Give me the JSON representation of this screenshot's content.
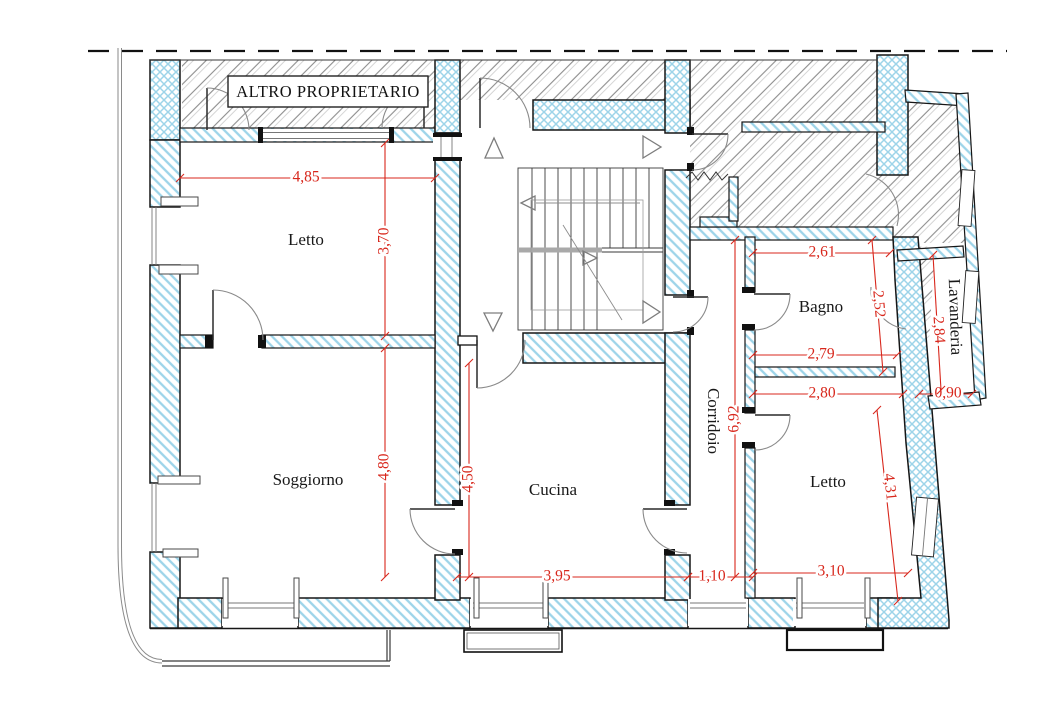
{
  "other_owner": {
    "label": "ALTRO PROPRIETARIO"
  },
  "rooms": [
    {
      "id": "letto-1",
      "label": "Letto",
      "x": 306,
      "y": 241,
      "rotation": 0
    },
    {
      "id": "soggiorno",
      "label": "Soggiorno",
      "x": 308,
      "y": 481,
      "rotation": 0
    },
    {
      "id": "cucina",
      "label": "Cucina",
      "x": 553,
      "y": 491,
      "rotation": 0
    },
    {
      "id": "corridoio",
      "label": "Corridoio",
      "x": 712,
      "y": 421,
      "rotation": 90
    },
    {
      "id": "bagno",
      "label": "Bagno",
      "x": 821,
      "y": 308,
      "rotation": 0
    },
    {
      "id": "lavanderia",
      "label": "Lavanderia",
      "x": 954,
      "y": 317,
      "rotation": 88
    },
    {
      "id": "letto-2",
      "label": "Letto",
      "x": 828,
      "y": 483,
      "rotation": 0
    }
  ],
  "dimensions": [
    {
      "id": "dim-4-85",
      "label": "4,85",
      "x": 306,
      "y": 178,
      "rotation": 0,
      "line": [
        180,
        178,
        435,
        178
      ]
    },
    {
      "id": "dim-3-70",
      "label": "3,70",
      "x": 385,
      "y": 241,
      "rotation": -90,
      "line": [
        385,
        143,
        385,
        336
      ]
    },
    {
      "id": "dim-4-80",
      "label": "4,80",
      "x": 385,
      "y": 467,
      "rotation": -90,
      "line": [
        385,
        348,
        385,
        577
      ]
    },
    {
      "id": "dim-4-50",
      "label": "4,50",
      "x": 469,
      "y": 479,
      "rotation": -90,
      "line": [
        469,
        363,
        469,
        577
      ]
    },
    {
      "id": "dim-3-95",
      "label": "3,95",
      "x": 557,
      "y": 577,
      "rotation": 0,
      "line": [
        457,
        577,
        688,
        577
      ]
    },
    {
      "id": "dim-1-10",
      "label": "1,10",
      "x": 712,
      "y": 577,
      "rotation": 0,
      "line": [
        688,
        577,
        753,
        577
      ]
    },
    {
      "id": "dim-3-10",
      "label": "3,10",
      "x": 831,
      "y": 572,
      "rotation": 0,
      "line": [
        753,
        573,
        908,
        573
      ]
    },
    {
      "id": "dim-2-61",
      "label": "2,61",
      "x": 822,
      "y": 253,
      "rotation": 0,
      "line": [
        753,
        253,
        890,
        253
      ]
    },
    {
      "id": "dim-2-52",
      "label": "2,52",
      "x": 878,
      "y": 304,
      "rotation": 85,
      "line": [
        872,
        240,
        883,
        372
      ]
    },
    {
      "id": "dim-2-79",
      "label": "2,79",
      "x": 821,
      "y": 355,
      "rotation": 0,
      "line": [
        753,
        355,
        897,
        355
      ]
    },
    {
      "id": "dim-2-80",
      "label": "2,80",
      "x": 822,
      "y": 394,
      "rotation": 0,
      "line": [
        753,
        394,
        903,
        394
      ]
    },
    {
      "id": "dim-0-90",
      "label": "0,90",
      "x": 948,
      "y": 394,
      "rotation": 0,
      "line": [
        919,
        394,
        972,
        394
      ]
    },
    {
      "id": "dim-2-84",
      "label": "2,84",
      "x": 938,
      "y": 330,
      "rotation": 86,
      "line": [
        933,
        255,
        941,
        390
      ]
    },
    {
      "id": "dim-6-92",
      "label": "6,92",
      "x": 735,
      "y": 419,
      "rotation": -90,
      "line": [
        735,
        240,
        735,
        577
      ]
    },
    {
      "id": "dim-4-31",
      "label": "4,31",
      "x": 889,
      "y": 487,
      "rotation": 84,
      "line": [
        877,
        410,
        898,
        601
      ]
    }
  ],
  "colors": {
    "dimension_red": "#d8271c",
    "wall_hatch_blue": "#9dd4e9",
    "other_property_hatch_gray": "#8d8d8d",
    "outline_black": "#161616"
  }
}
